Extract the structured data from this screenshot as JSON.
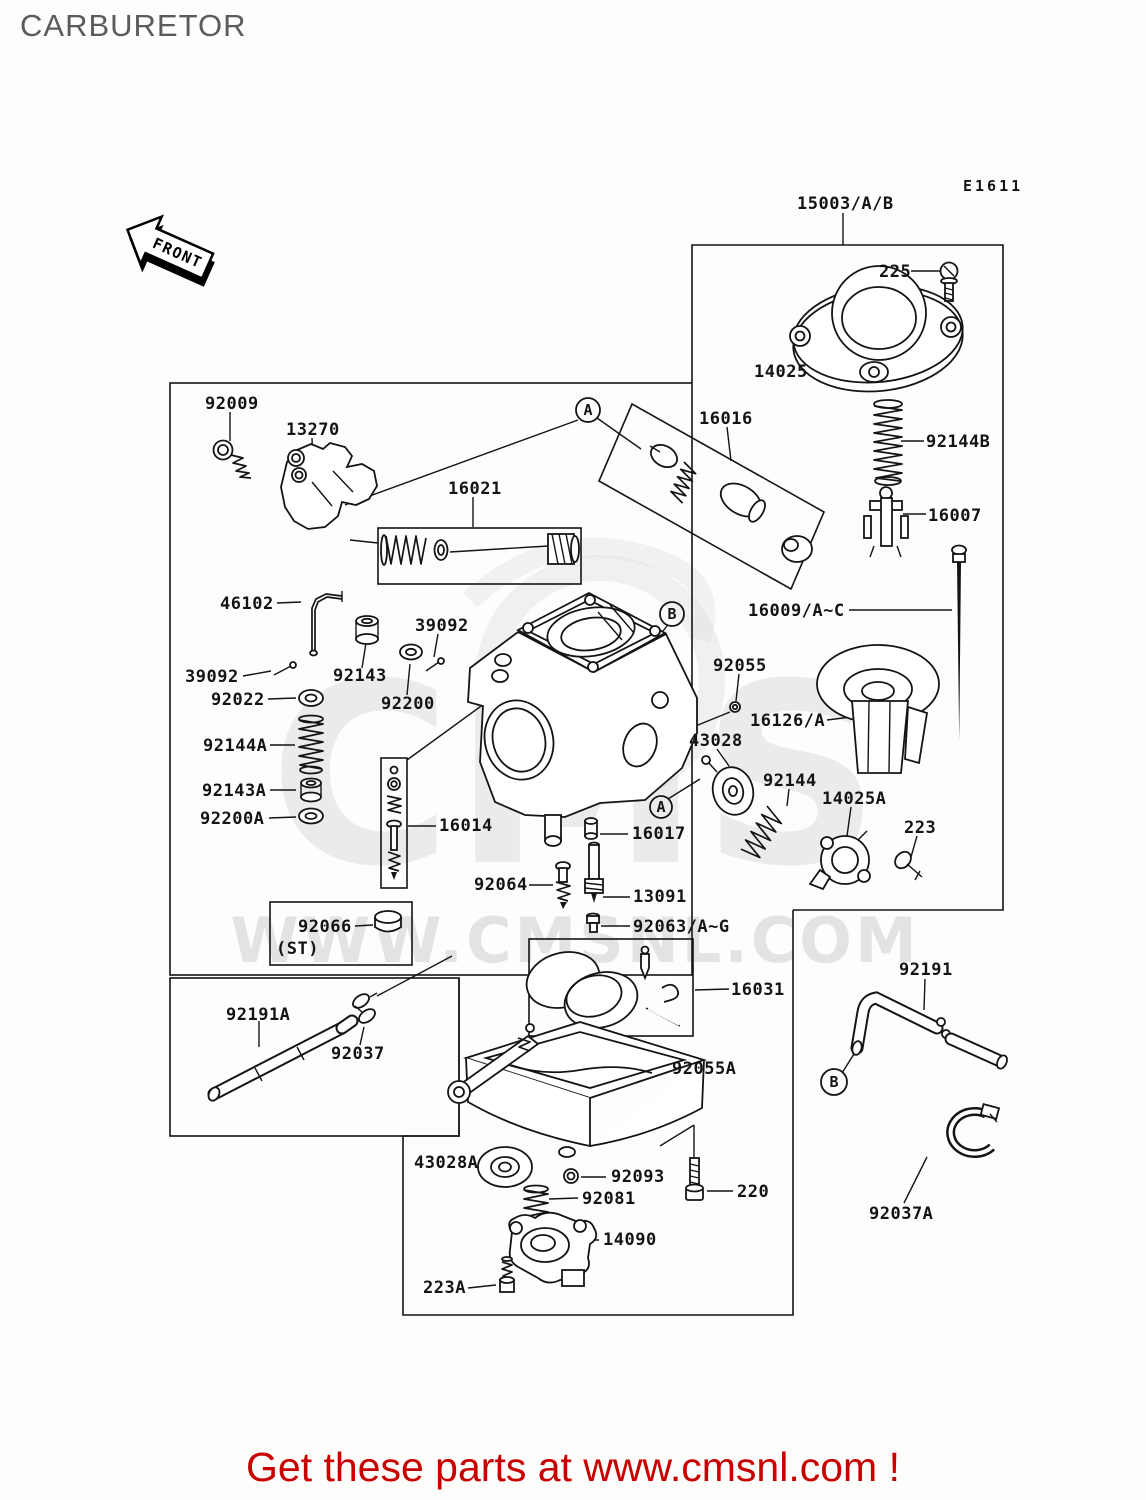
{
  "page": {
    "title": "CARBURETOR",
    "diagram_code": "E1611"
  },
  "front_arrow": {
    "label": "FRONT"
  },
  "watermark": {
    "logo": "CMS",
    "url": "WWW.CMSNL.COM"
  },
  "footer": {
    "cta": "Get these parts at www.cmsnl.com !"
  },
  "colors": {
    "footer_red": "#c80000",
    "title_gray": "#5b5b5d",
    "line_black": "#141414",
    "watermark_gray": "#d4d4d4"
  },
  "markers": {
    "a": "A",
    "b": "B"
  },
  "labels": {
    "p15003": {
      "label": "15003/A/B"
    },
    "p225": {
      "label": "225"
    },
    "p14025": {
      "label": "14025"
    },
    "p16016": {
      "label": "16016"
    },
    "p92144B": {
      "label": "92144B"
    },
    "p16007": {
      "label": "16007"
    },
    "p16009": {
      "label": "16009/A~C"
    },
    "p92055": {
      "label": "92055"
    },
    "p16126": {
      "label": "16126/A"
    },
    "p43028": {
      "label": "43028"
    },
    "p92144": {
      "label": "92144"
    },
    "p14025A": {
      "label": "14025A"
    },
    "p223": {
      "label": "223"
    },
    "p16017": {
      "label": "16017"
    },
    "p13091": {
      "label": "13091"
    },
    "p92063": {
      "label": "92063/A~G"
    },
    "p16031": {
      "label": "16031"
    },
    "p92191": {
      "label": "92191"
    },
    "p92009": {
      "label": "92009"
    },
    "p13270": {
      "label": "13270"
    },
    "p16021": {
      "label": "16021"
    },
    "p46102": {
      "label": "46102"
    },
    "p39092_top": {
      "label": "39092"
    },
    "p39092_left": {
      "label": "39092"
    },
    "p92143": {
      "label": "92143"
    },
    "p92022": {
      "label": "92022"
    },
    "p92200": {
      "label": "92200"
    },
    "p92144A": {
      "label": "92144A"
    },
    "p92143A": {
      "label": "92143A"
    },
    "p92200A": {
      "label": "92200A"
    },
    "p16014": {
      "label": "16014"
    },
    "p92064": {
      "label": "92064"
    },
    "p92066": {
      "label": "92066"
    },
    "p92066_st": {
      "label": "(ST)"
    },
    "p92191A": {
      "label": "92191A"
    },
    "p92037": {
      "label": "92037"
    },
    "p92055A": {
      "label": "92055A"
    },
    "p43028A": {
      "label": "43028A"
    },
    "p92093": {
      "label": "92093"
    },
    "p220": {
      "label": "220"
    },
    "p92081": {
      "label": "92081"
    },
    "p14090": {
      "label": "14090"
    },
    "p223A": {
      "label": "223A"
    },
    "p92037A": {
      "label": "92037A"
    }
  }
}
